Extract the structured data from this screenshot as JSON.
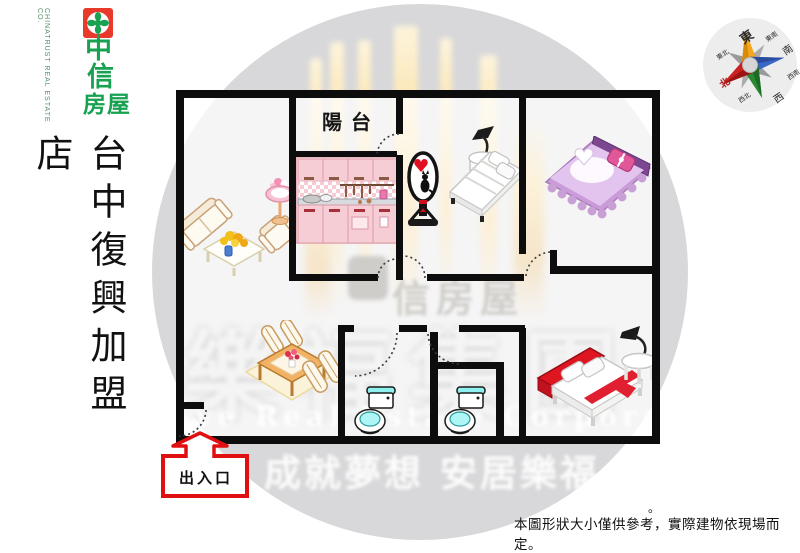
{
  "brand": {
    "zh_char1": "中",
    "zh_char2": "信",
    "zh_chars34": "房屋",
    "en": "CHINATRUST REAL ESTATE CO.",
    "green": "#18a150",
    "emblem_red": "#e8392b"
  },
  "store_title": {
    "text": "台中復興加盟店"
  },
  "plan": {
    "balcony_label": "陽台",
    "entrance_label": "出入口",
    "wall_color": "#0d0d0d",
    "entrance_accent": "#e01010"
  },
  "compass": {
    "north_color": "#b22222",
    "labels": [
      {
        "label": "東"
      },
      {
        "label": "東南"
      },
      {
        "label": "南"
      },
      {
        "label": "西南"
      },
      {
        "label": "西"
      },
      {
        "label": "西北"
      },
      {
        "label": "北"
      },
      {
        "label": "東北"
      }
    ]
  },
  "watermarks": {
    "brand_text": "信房屋",
    "team_text": "樂福集團",
    "en_text": "ve Real Estate Corporation",
    "slogan_text": "成就夢想 安居樂福"
  },
  "disclaimer": {
    "text": "本圖形狀大小僅供參考，實際建物依現場而定。",
    "floating_mark": "。"
  }
}
